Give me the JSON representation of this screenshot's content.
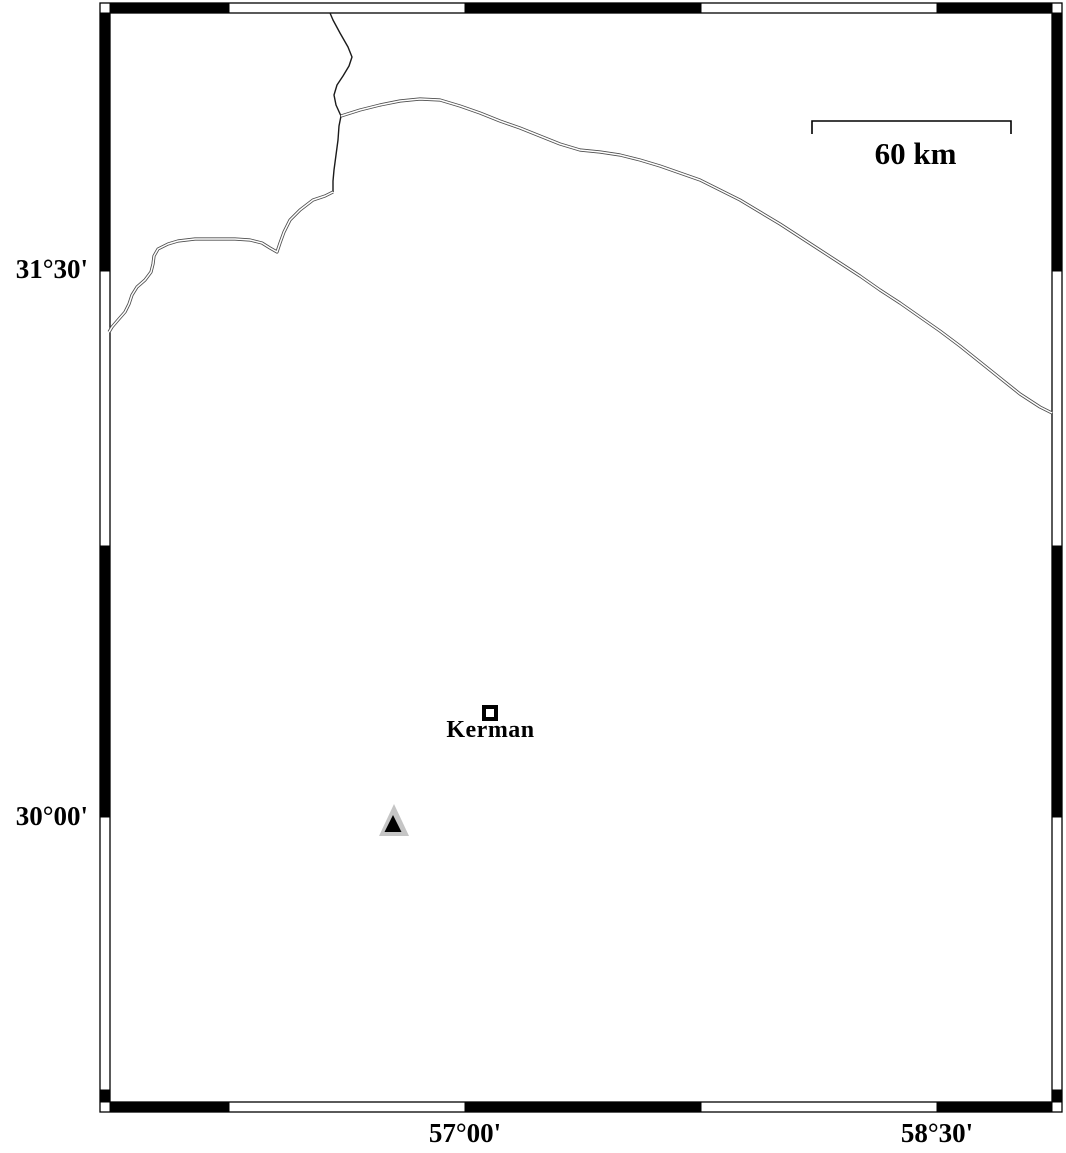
{
  "map": {
    "region_labels": {
      "lat_upper": "31°30'",
      "lat_lower": "30°00'",
      "lon_left": "57°00'",
      "lon_right": "58°30'"
    },
    "scale_bar": {
      "label": "60 km",
      "x1": 812,
      "x2": 1011,
      "y": 121,
      "tick_drop": 13
    },
    "city": {
      "label": "Kerman",
      "x": 490,
      "y": 713
    },
    "frame": {
      "outer": {
        "x1": 100,
        "y1": 3,
        "x2": 1062,
        "y2": 1112
      },
      "inner": {
        "x1": 110,
        "y1": 13,
        "x2": 1052,
        "y2": 1102
      },
      "x_boundaries": [
        110,
        229,
        465,
        701,
        937,
        1052
      ],
      "y_boundaries": [
        13,
        271,
        546,
        817,
        1090,
        1102
      ]
    },
    "colors": {
      "black": "#000000",
      "white": "#ffffff",
      "single_line": "#1a1a1a",
      "double_line": "#4d4d4d",
      "triangle_outer": "#c5c5c5",
      "triangle_inner": "#000000"
    },
    "features": {
      "boundary_north": {
        "style": "single",
        "points": [
          [
            330,
            13
          ],
          [
            333,
            20
          ],
          [
            340,
            33
          ],
          [
            348,
            47
          ],
          [
            352,
            57
          ],
          [
            349,
            66
          ],
          [
            343,
            76
          ],
          [
            337,
            85
          ],
          [
            334,
            95
          ],
          [
            336,
            105
          ],
          [
            341,
            116
          ],
          [
            339,
            126
          ],
          [
            338,
            140
          ],
          [
            336,
            155
          ],
          [
            334,
            170
          ],
          [
            333,
            181
          ],
          [
            333,
            192
          ]
        ]
      },
      "boundary_northeast": {
        "style": "double",
        "points": [
          [
            341,
            116
          ],
          [
            360,
            110
          ],
          [
            380,
            105
          ],
          [
            400,
            101
          ],
          [
            420,
            99
          ],
          [
            440,
            100
          ],
          [
            460,
            106
          ],
          [
            480,
            113
          ],
          [
            500,
            121
          ],
          [
            520,
            128
          ],
          [
            540,
            136
          ],
          [
            560,
            144
          ],
          [
            580,
            150
          ],
          [
            600,
            152
          ],
          [
            620,
            155
          ],
          [
            640,
            160
          ],
          [
            660,
            166
          ],
          [
            680,
            173
          ],
          [
            700,
            180
          ],
          [
            720,
            190
          ],
          [
            740,
            200
          ],
          [
            760,
            212
          ],
          [
            780,
            224
          ],
          [
            800,
            237
          ],
          [
            820,
            250
          ],
          [
            840,
            263
          ],
          [
            860,
            276
          ],
          [
            880,
            290
          ],
          [
            900,
            303
          ],
          [
            920,
            317
          ],
          [
            940,
            331
          ],
          [
            960,
            346
          ],
          [
            980,
            362
          ],
          [
            1000,
            378
          ],
          [
            1020,
            394
          ],
          [
            1040,
            407
          ],
          [
            1052,
            413
          ]
        ]
      },
      "boundary_west": {
        "style": "double",
        "points": [
          [
            333,
            192
          ],
          [
            325,
            196
          ],
          [
            313,
            200
          ],
          [
            300,
            210
          ],
          [
            290,
            220
          ],
          [
            284,
            232
          ],
          [
            280,
            243
          ],
          [
            277,
            252
          ],
          [
            270,
            248
          ],
          [
            262,
            243
          ],
          [
            250,
            240
          ],
          [
            235,
            239
          ],
          [
            215,
            239
          ],
          [
            195,
            239
          ],
          [
            178,
            241
          ],
          [
            168,
            244
          ],
          [
            158,
            249
          ],
          [
            154,
            256
          ],
          [
            153,
            264
          ],
          [
            151,
            272
          ],
          [
            145,
            280
          ],
          [
            137,
            287
          ],
          [
            132,
            295
          ],
          [
            129,
            304
          ],
          [
            125,
            312
          ],
          [
            118,
            320
          ],
          [
            112,
            327
          ],
          [
            109,
            332
          ]
        ]
      }
    },
    "station_triangle": {
      "outer": [
        [
          394,
          804
        ],
        [
          379,
          836
        ],
        [
          409,
          836
        ]
      ],
      "inner": [
        [
          393,
          815
        ],
        [
          384.5,
          832
        ],
        [
          401.5,
          832
        ]
      ]
    }
  }
}
